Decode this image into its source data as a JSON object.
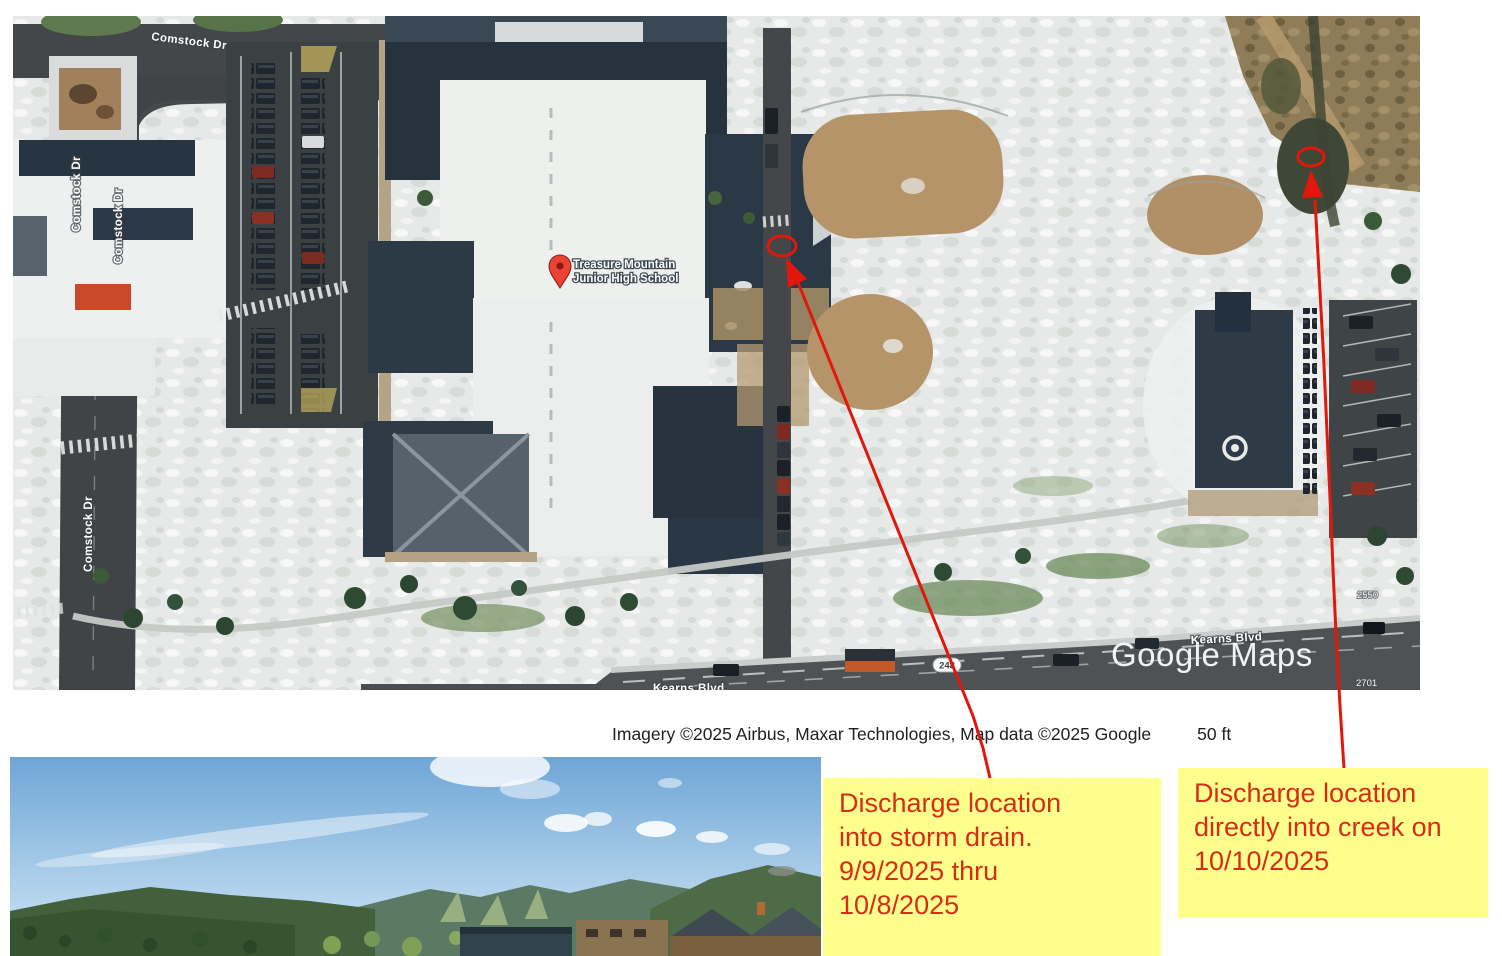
{
  "map": {
    "attribution": "Imagery ©2025 Airbus, Maxar Technologies, Map data ©2025 Google",
    "scale_label": "50 ft",
    "watermark": "Google Maps",
    "pin": {
      "line1": "Treasure Mountain",
      "line2": "Junior High School",
      "color": "#EA4335"
    },
    "streets": {
      "comstock": "Comstock Dr",
      "kearns": "Kearns Blvd",
      "route_badge": "248"
    },
    "parcel_labels": {
      "n2550": "2550",
      "n2701": "2701"
    }
  },
  "notes": {
    "storm_drain": {
      "lines": [
        "Discharge location",
        "into storm drain.",
        "9/9/2025 thru",
        "10/8/2025"
      ]
    },
    "creek": {
      "lines": [
        "Discharge location",
        "directly into creek on",
        "10/10/2025"
      ]
    },
    "style": {
      "background": "#FFFF8E",
      "text_color": "#D92C17",
      "annotation_red": "#E2170C"
    }
  }
}
